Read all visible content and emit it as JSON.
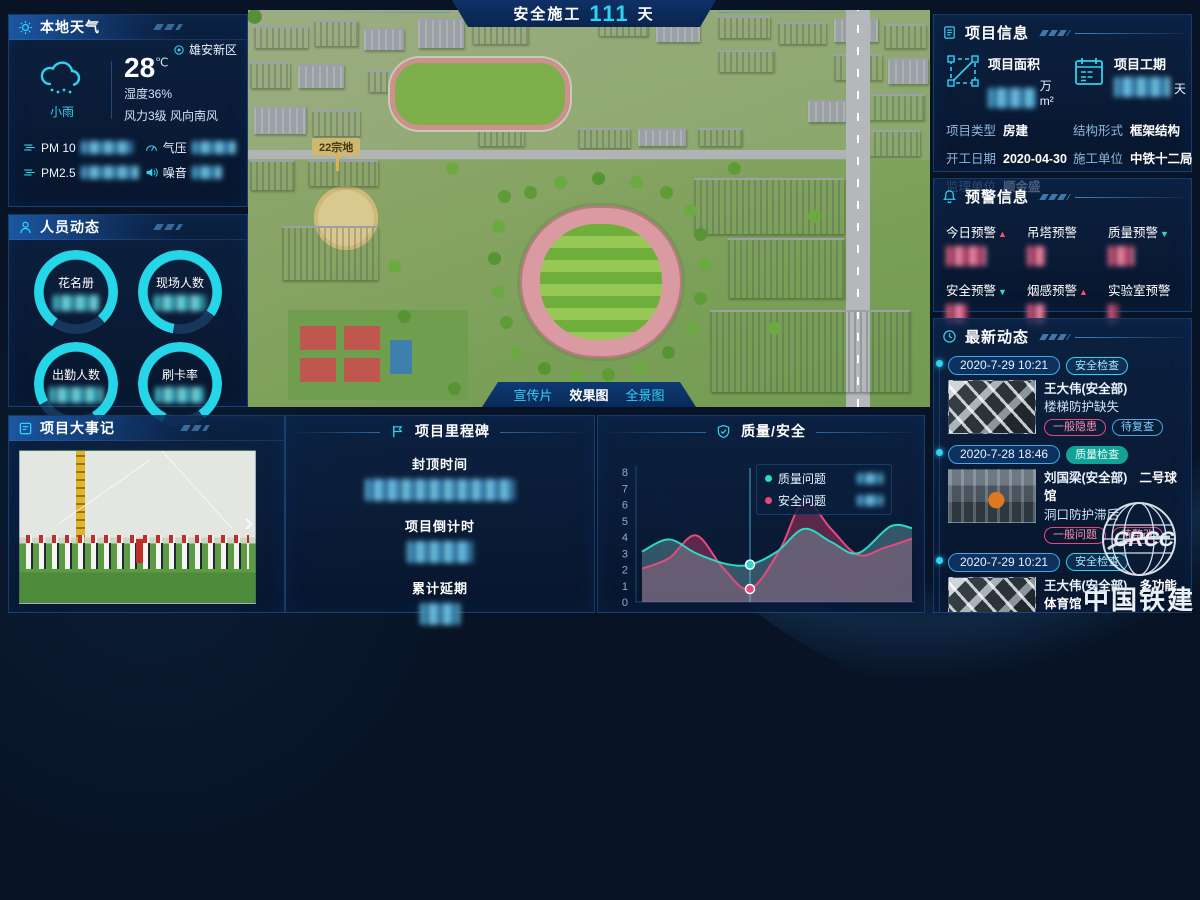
{
  "header": {
    "label": "安全施工",
    "days": "111",
    "unit": "天"
  },
  "weather": {
    "title": "本地天气",
    "location": "雄安新区",
    "temp": "28",
    "temp_unit": "℃",
    "condition": "小雨",
    "humidity": "湿度36%",
    "wind": "风力3级 风向南风",
    "metrics": [
      {
        "label": "PM 10",
        "icon": "fog-icon"
      },
      {
        "label": "气压",
        "icon": "pressure-icon"
      },
      {
        "label": "PM2.5",
        "icon": "fog-icon"
      },
      {
        "label": "噪音",
        "icon": "noise-icon"
      }
    ]
  },
  "personnel": {
    "title": "人员动态",
    "rings": [
      {
        "label": "花名册"
      },
      {
        "label": "现场人数"
      },
      {
        "label": "出勤人数"
      },
      {
        "label": "刷卡率"
      }
    ]
  },
  "events": {
    "title": "项目大事记",
    "next_arrow": "›"
  },
  "aerial": {
    "plot_label": "22宗地",
    "tabs": [
      {
        "label": "宣传片",
        "active": false
      },
      {
        "label": "效果图",
        "active": true
      },
      {
        "label": "全景图",
        "active": false
      }
    ]
  },
  "milestones": {
    "title": "项目里程碑",
    "items": [
      {
        "label": "封顶时间"
      },
      {
        "label": "项目倒计时"
      },
      {
        "label": "累计延期"
      }
    ]
  },
  "chart_data": {
    "type": "area",
    "title": "质量/安全",
    "categories": [
      "10-06",
      "10-07",
      "10-08",
      "10-09",
      "10-10",
      "10-11"
    ],
    "ylim": [
      0,
      8
    ],
    "yticks": [
      0,
      1,
      2,
      3,
      4,
      5,
      6,
      7,
      8
    ],
    "grid": false,
    "legend_position": "tooltip-over-plot",
    "highlight_category": "10-08",
    "series": [
      {
        "name": "质量问题",
        "color": "#2bd9c5",
        "values": [
          3.1,
          3.0,
          2.3,
          4.5,
          3.0,
          4.6
        ],
        "smooth_x": [
          0,
          0.5,
          1,
          1.55,
          2,
          2.5,
          3,
          3.5,
          4,
          4.6,
          5
        ],
        "smooth_y": [
          3.1,
          3.85,
          3.0,
          2.35,
          2.3,
          3.1,
          4.5,
          3.7,
          3.0,
          4.65,
          4.55
        ]
      },
      {
        "name": "安全问题",
        "color": "#e5497e",
        "values": [
          2.1,
          4.1,
          0.8,
          6.2,
          2.9,
          3.9
        ],
        "smooth_x": [
          0,
          0.5,
          1,
          1.5,
          2,
          2.55,
          3,
          3.5,
          4,
          4.5,
          5
        ],
        "smooth_y": [
          2.05,
          2.7,
          4.1,
          2.1,
          0.8,
          3.2,
          6.2,
          4.5,
          2.9,
          3.35,
          3.9
        ]
      }
    ]
  },
  "project_info": {
    "title": "项目信息",
    "stats": [
      {
        "label": "项目面积",
        "unit": "万m²",
        "icon": "area-icon"
      },
      {
        "label": "项目工期",
        "unit": "天",
        "icon": "calendar-icon"
      }
    ],
    "rows": [
      {
        "label": "项目类型",
        "value": "房建"
      },
      {
        "label": "结构形式",
        "value": "框架结构"
      },
      {
        "label": "开工日期",
        "value": "2020-04-30"
      },
      {
        "label": "施工单位",
        "value": "中铁十二局"
      },
      {
        "label": "监理单位",
        "value": "顺金盛"
      }
    ]
  },
  "warnings": {
    "title": "预警信息",
    "items": [
      {
        "label": "今日预警",
        "trend": "up"
      },
      {
        "label": "吊塔预警",
        "trend": ""
      },
      {
        "label": "质量预警",
        "trend": "down"
      },
      {
        "label": "安全预警",
        "trend": "down"
      },
      {
        "label": "烟感预警",
        "trend": "up"
      },
      {
        "label": "实验室预警",
        "trend": ""
      }
    ]
  },
  "news": {
    "title": "最新动态",
    "items": [
      {
        "date": "2020-7-29 10:21",
        "type": "安全检查",
        "type_class": "safe",
        "photo": "steel",
        "person": "王大伟(安全部)",
        "place": "",
        "issue": "楼梯防护缺失",
        "tags": [
          {
            "label": "一般隐患",
            "tone": "pink"
          },
          {
            "label": "待复查",
            "tone": "blue"
          }
        ]
      },
      {
        "date": "2020-7-28 18:46",
        "type": "质量检查",
        "type_class": "qual",
        "photo": "worker",
        "person": "刘国梁(安全部)",
        "place": "二号球馆",
        "issue": "洞口防护滞后",
        "tags": [
          {
            "label": "一般问题",
            "tone": "pink"
          },
          {
            "label": "待整改",
            "tone": "pink"
          }
        ]
      },
      {
        "date": "2020-7-29 10:21",
        "type": "安全检查",
        "type_class": "safe",
        "photo": "steel",
        "person": "王大伟(安全部)",
        "place": "多功能体育馆",
        "issue": "楼梯防护缺失",
        "tags": [
          {
            "label": "一般隐患",
            "tone": "pink"
          },
          {
            "label": "待复查",
            "tone": "blue"
          }
        ]
      },
      {
        "date": "2020-7-28 18:46",
        "type": "质量检查",
        "type_class": "qual",
        "photo": "darkwall",
        "person": "刘国梁(安全部)",
        "place": "",
        "issue": "",
        "tags": []
      }
    ]
  },
  "logo": {
    "cn": "中国铁建",
    "en": "CRCC"
  },
  "colors": {
    "accent": "#2fd3f0",
    "teal": "#2bd9c5",
    "pink": "#e5497e",
    "panel_border": "#2c76c2"
  }
}
